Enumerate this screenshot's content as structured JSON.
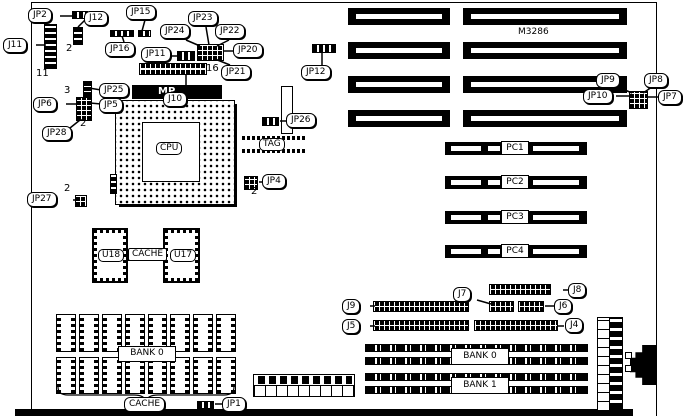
{
  "board": {
    "model_text": "M3286"
  },
  "labels": {
    "jp2": "JP2",
    "j11": "J11",
    "j12": "J12",
    "jp15": "JP15",
    "jp16": "JP16",
    "jp23": "JP23",
    "jp24": "JP24",
    "jp22": "JP22",
    "jp20": "JP20",
    "jp21": "JP21",
    "jp11": "JP11",
    "j10": "J10",
    "jp25": "JP25",
    "jp5": "JP5",
    "jp6": "JP6",
    "jp28": "JP28",
    "jp26": "JP26",
    "jp12": "JP12",
    "jp4": "JP4",
    "jp27": "JP27",
    "jp9": "JP9",
    "jp8": "JP8",
    "jp10": "JP10",
    "jp7": "JP7",
    "j9": "J9",
    "j5": "J5",
    "j7": "J7",
    "j8": "J8",
    "j6": "J6",
    "j4": "J4",
    "jp1": "JP1"
  },
  "chips": {
    "cpu": "CPU",
    "tag": "TAG",
    "mp": "MP",
    "u18": "U18",
    "u17": "U17",
    "cache": "CACHE"
  },
  "slots": {
    "pc1": "PC1",
    "pc2": "PC2",
    "pc3": "PC3",
    "pc4": "PC4"
  },
  "memory": {
    "dip_bank": "BANK 0",
    "dip_cache": "CACHE",
    "simm_bank0": "BANK 0",
    "simm_bank1": "BANK 1"
  },
  "pins": {
    "j11": "11",
    "j12": "2",
    "j10": "16",
    "jp5": "3",
    "jp6": "2",
    "jp27": "2",
    "jp4": "2"
  }
}
